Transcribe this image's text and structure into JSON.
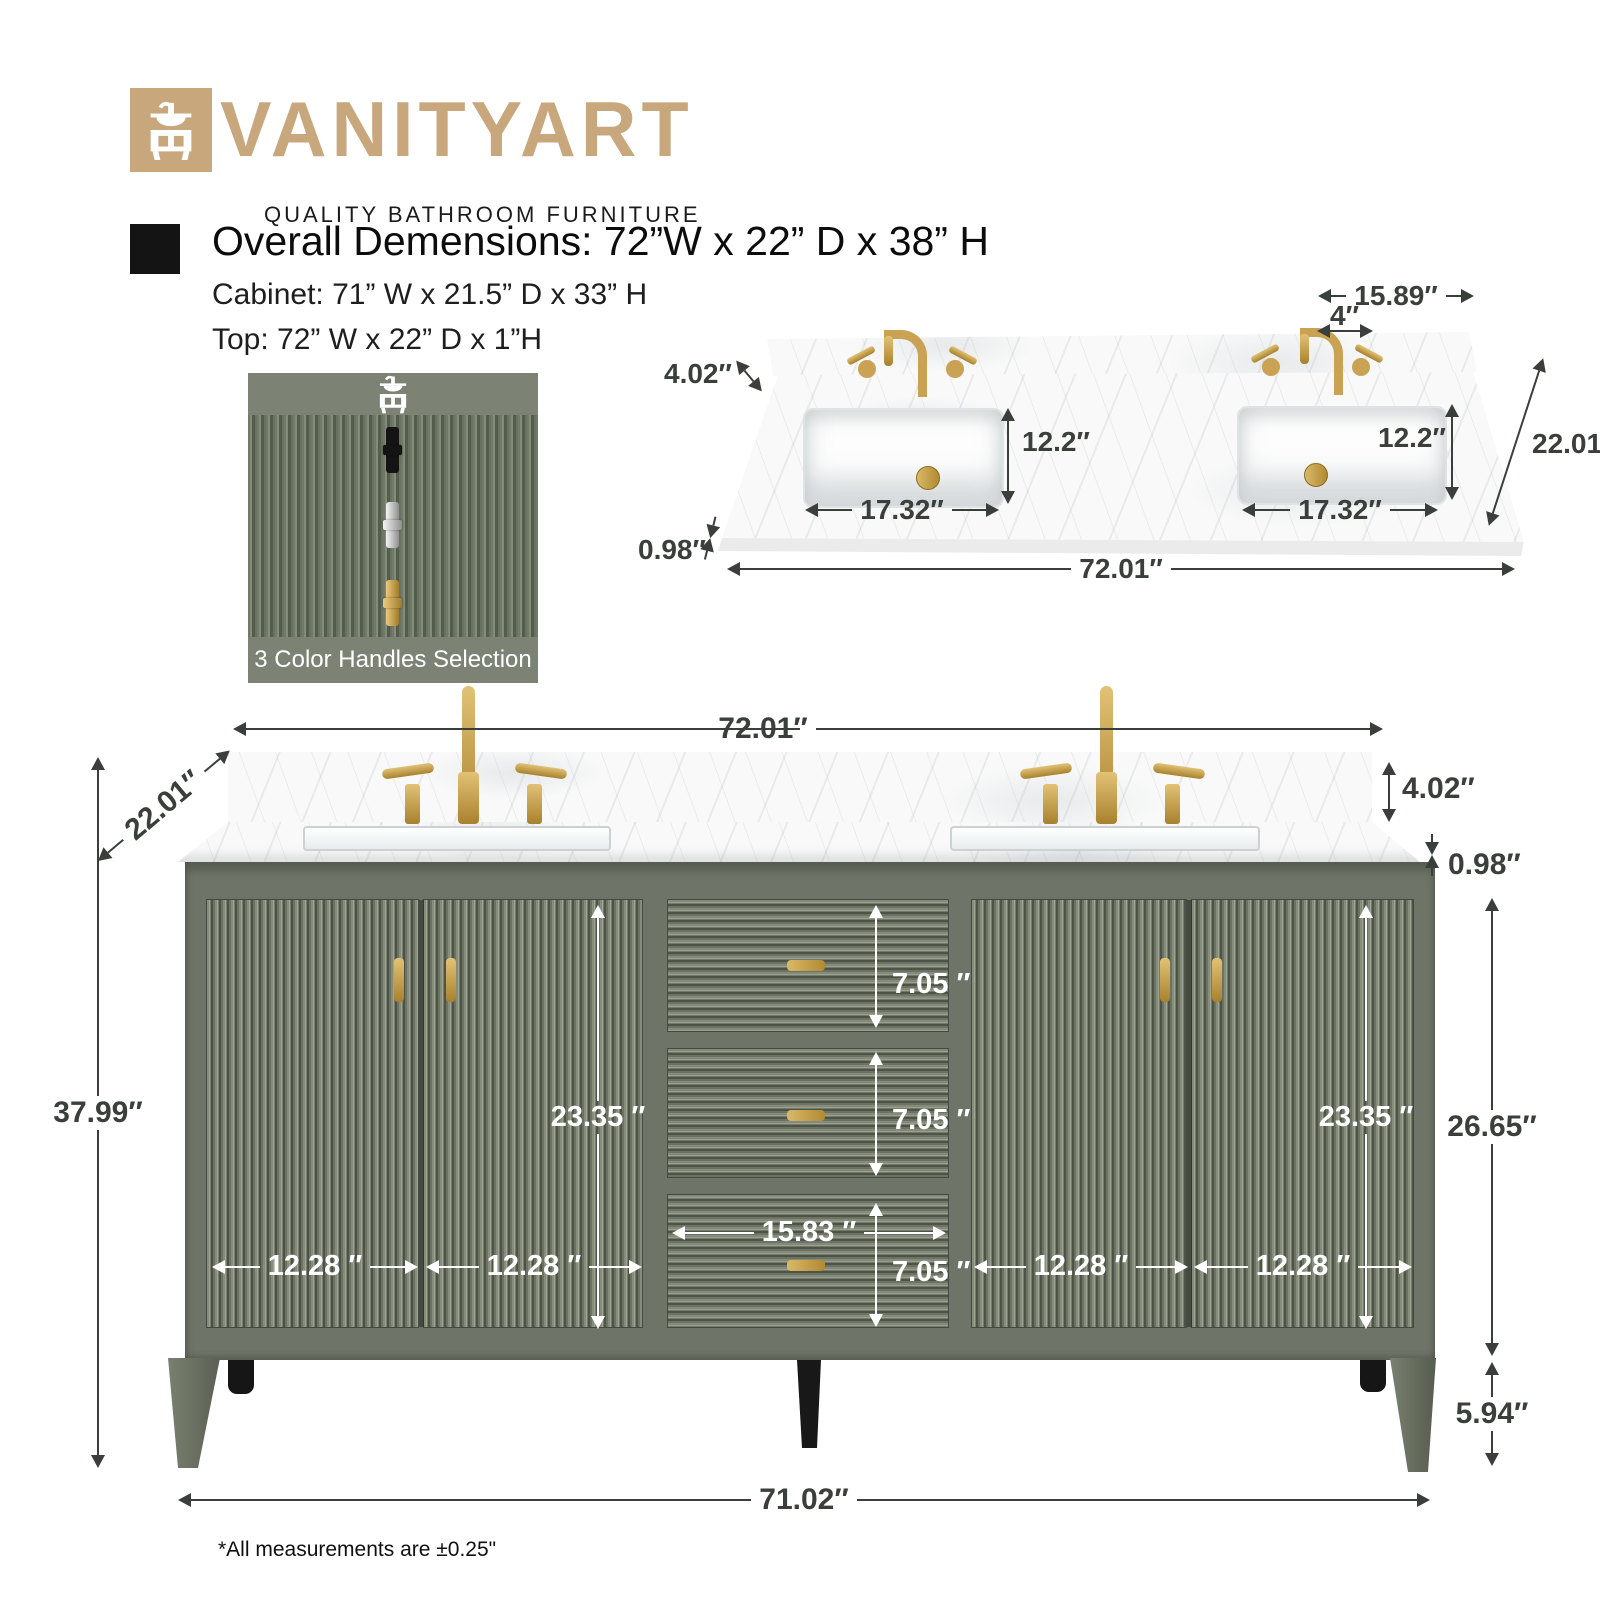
{
  "brand": {
    "name": "VANITYART",
    "tagline": "QUALITY BATHROOM FURNITURE",
    "brand_color": "#c8a77d"
  },
  "specs": {
    "overall": "Overall Demensions: 72”W x 22” D x 38” H",
    "cabinet": "Cabinet: 71” W x 21.5” D x 33” H",
    "top": "Top: 72” W x 22” D x 1”H"
  },
  "handle_selection": {
    "caption": "3 Color Handles Selection",
    "options": [
      "black",
      "chrome",
      "gold"
    ]
  },
  "colors": {
    "cabinet_green": "#6e7468",
    "hardware_gold": "#c9a254",
    "dim_dark": "#3a3f3b",
    "dim_white": "#ffffff"
  },
  "top_view": {
    "faucet_spread": "15.89″",
    "hole_spacing": "4″",
    "backsplash_height": "4.02″",
    "sink_depth": "12.2″",
    "counter_depth": "22.01″",
    "sink_width": "17.32″",
    "thickness": "0.98″",
    "width": "72.01″"
  },
  "front_view": {
    "width": "72.01″",
    "depth": "22.01″",
    "backsplash_height": "4.02″",
    "thickness": "0.98″",
    "height": "37.99″",
    "door_height": "23.35 ″",
    "drawer_height": "7.05 ″",
    "mid_drawer_width": "15.83 ″",
    "door_width": "12.28 ″",
    "body_height": "26.65″",
    "leg_height": "5.94″",
    "base_width": "71.02″"
  },
  "footnote": "*All measurements are ±0.25\""
}
